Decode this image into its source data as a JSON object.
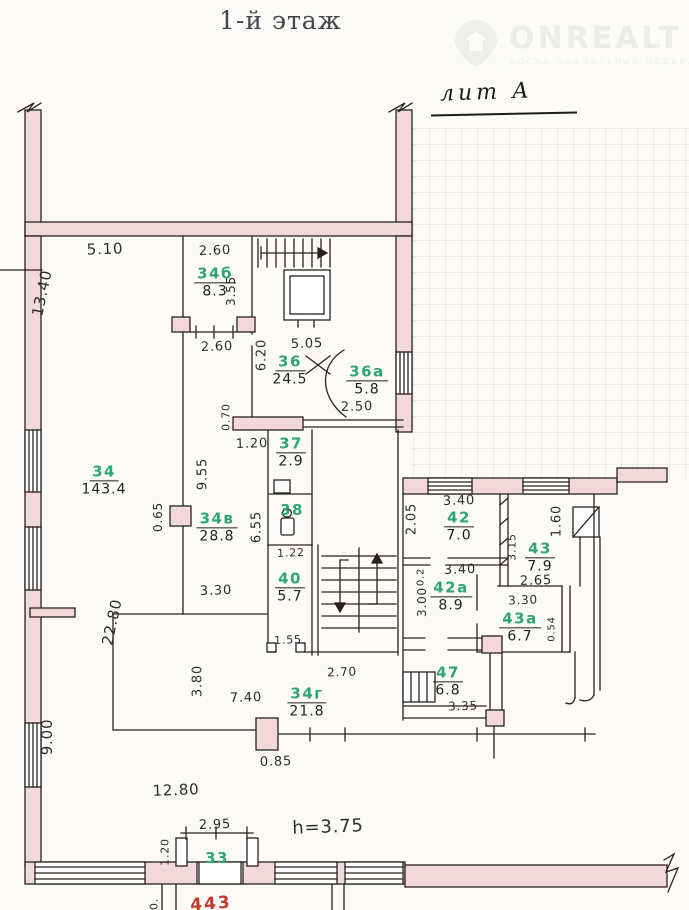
{
  "page": {
    "title": "1-й этаж",
    "liter": "лит А"
  },
  "logo": {
    "name": "ONREALT",
    "tagline": "ДОСКА ОБЪЯВЛЕНИЙ НЕДВИЖИМОСТИ"
  },
  "colors": {
    "wall_fill": "#f2d8da",
    "line": "#26221f",
    "room_number_green": "#2fa476",
    "dimension_text": "#2e2d2b",
    "red_note": "#c23b2e"
  },
  "plan": {
    "rooms": [
      {
        "number": "34",
        "area": "143.4",
        "x": 104,
        "y": 480
      },
      {
        "number": "34б",
        "area": "8.3",
        "x": 215,
        "y": 282
      },
      {
        "number": "34в",
        "area": "28.8",
        "x": 217,
        "y": 527
      },
      {
        "number": "34г",
        "area": "21.8",
        "x": 307,
        "y": 702
      },
      {
        "number": "36",
        "area": "24.5",
        "x": 290,
        "y": 370
      },
      {
        "number": "36а",
        "area": "5.8",
        "x": 367,
        "y": 380
      },
      {
        "number": "37",
        "area": "2.9",
        "x": 291,
        "y": 452
      },
      {
        "number": "38",
        "area": "",
        "x": 292,
        "y": 510
      },
      {
        "number": "40",
        "area": "5.7",
        "x": 290,
        "y": 587
      },
      {
        "number": "42",
        "area": "7.0",
        "x": 459,
        "y": 526
      },
      {
        "number": "42а",
        "area": "8.9",
        "x": 451,
        "y": 596
      },
      {
        "number": "43",
        "area": "7.9",
        "x": 540,
        "y": 557
      },
      {
        "number": "43а",
        "area": "6.7",
        "x": 520,
        "y": 627
      },
      {
        "number": "47",
        "area": "6.8",
        "x": 448,
        "y": 681
      },
      {
        "number": "33",
        "area": "",
        "x": 217,
        "y": 858
      }
    ],
    "dimensions": [
      {
        "text": "5.10",
        "x": 105,
        "y": 249,
        "size": 15
      },
      {
        "text": "2.60",
        "x": 215,
        "y": 251
      },
      {
        "text": "3.55",
        "x": 231,
        "y": 291,
        "rot": -90,
        "size": 12
      },
      {
        "text": "2.60",
        "x": 217,
        "y": 347
      },
      {
        "text": "6.20",
        "x": 262,
        "y": 355,
        "rot": -90
      },
      {
        "text": "5.05",
        "x": 307,
        "y": 344
      },
      {
        "text": "2.50",
        "x": 357,
        "y": 407
      },
      {
        "text": "13.40",
        "x": 42,
        "y": 293,
        "rot": -78,
        "size": 15
      },
      {
        "text": "0.70",
        "x": 226,
        "y": 417,
        "rot": -90,
        "size": 11
      },
      {
        "text": "1.20",
        "x": 252,
        "y": 444
      },
      {
        "text": "9.55",
        "x": 203,
        "y": 474,
        "rot": -90
      },
      {
        "text": "0.65",
        "x": 158,
        "y": 517,
        "rot": -90,
        "size": 12
      },
      {
        "text": "6.55",
        "x": 257,
        "y": 527,
        "rot": -90
      },
      {
        "text": "1.22",
        "x": 291,
        "y": 553,
        "size": 11
      },
      {
        "text": "3.30",
        "x": 216,
        "y": 591
      },
      {
        "text": "22.80",
        "x": 112,
        "y": 622,
        "rot": -78,
        "size": 15
      },
      {
        "text": "1.55",
        "x": 288,
        "y": 640,
        "size": 11
      },
      {
        "text": "3.80",
        "x": 198,
        "y": 681,
        "rot": -90
      },
      {
        "text": "7.40",
        "x": 246,
        "y": 698
      },
      {
        "text": "2.70",
        "x": 342,
        "y": 672,
        "size": 12
      },
      {
        "text": "0.85",
        "x": 276,
        "y": 762
      },
      {
        "text": "9.00",
        "x": 47,
        "y": 737,
        "rot": -90,
        "size": 15
      },
      {
        "text": "12.80",
        "x": 176,
        "y": 790,
        "size": 15
      },
      {
        "text": "2.95",
        "x": 215,
        "y": 825
      },
      {
        "text": "1.20",
        "x": 165,
        "y": 852,
        "rot": -90,
        "size": 11
      },
      {
        "text": "h=3.75",
        "x": 328,
        "y": 827,
        "size": 18
      },
      {
        "text": "2.05",
        "x": 412,
        "y": 519,
        "rot": -90
      },
      {
        "text": "3.40",
        "x": 459,
        "y": 501
      },
      {
        "text": "3.15",
        "x": 512,
        "y": 547,
        "rot": -90,
        "size": 11
      },
      {
        "text": "1.60",
        "x": 557,
        "y": 521,
        "rot": -90
      },
      {
        "text": "2.65",
        "x": 536,
        "y": 581
      },
      {
        "text": "3.40",
        "x": 460,
        "y": 570
      },
      {
        "text": "0.2",
        "x": 421,
        "y": 577,
        "rot": -90,
        "size": 10
      },
      {
        "text": "3.00",
        "x": 422,
        "y": 602,
        "rot": -90,
        "size": 12
      },
      {
        "text": "3.30",
        "x": 523,
        "y": 600,
        "size": 12
      },
      {
        "text": "0.54",
        "x": 552,
        "y": 629,
        "rot": -90,
        "size": 10
      },
      {
        "text": "3.35",
        "x": 463,
        "y": 706,
        "size": 12
      },
      {
        "text": "0.",
        "x": 154,
        "y": 904,
        "rot": -90,
        "size": 11
      }
    ],
    "red_note": {
      "text": "443"
    }
  }
}
